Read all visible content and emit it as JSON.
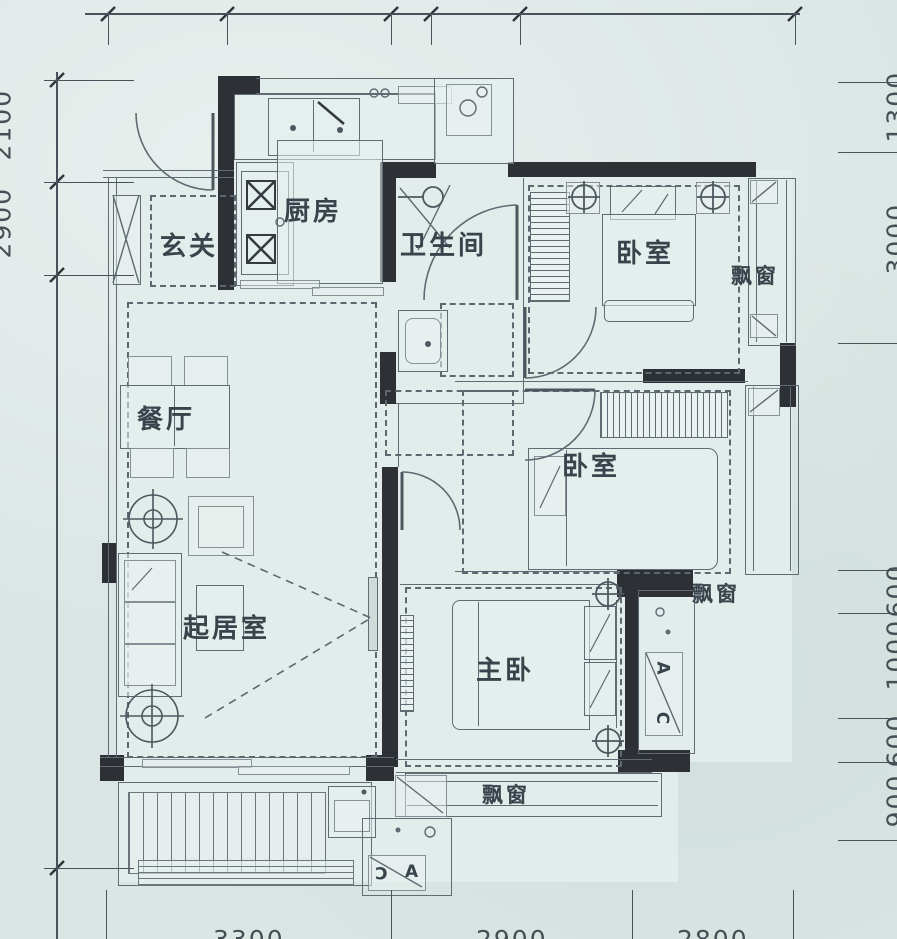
{
  "plan": {
    "rooms": {
      "foyer": "玄关",
      "kitchen": "厨房",
      "bathroom": "卫生间",
      "bedroom_top": "卧室",
      "bedroom_mid": "卧室",
      "master_bedroom": "主卧",
      "dining": "餐厅",
      "living": "起居室"
    },
    "bay_windows": {
      "top": "飘窗",
      "middle": "飘窗",
      "bottom": "飘窗"
    },
    "ac": {
      "right_top": "A",
      "right_bottom": "C",
      "bottom_left": "C",
      "bottom_right": "A"
    },
    "dimensions": {
      "bottom": [
        "3300",
        "2900",
        "2800"
      ],
      "left": [
        "2100",
        "2900"
      ],
      "right": [
        "1300",
        "3000",
        "600",
        "1000",
        "600",
        "900"
      ]
    },
    "colors": {
      "wall": "#2d3136",
      "line": "#5f6a72",
      "background": "#dbe6e4",
      "label": "#39434b"
    }
  }
}
